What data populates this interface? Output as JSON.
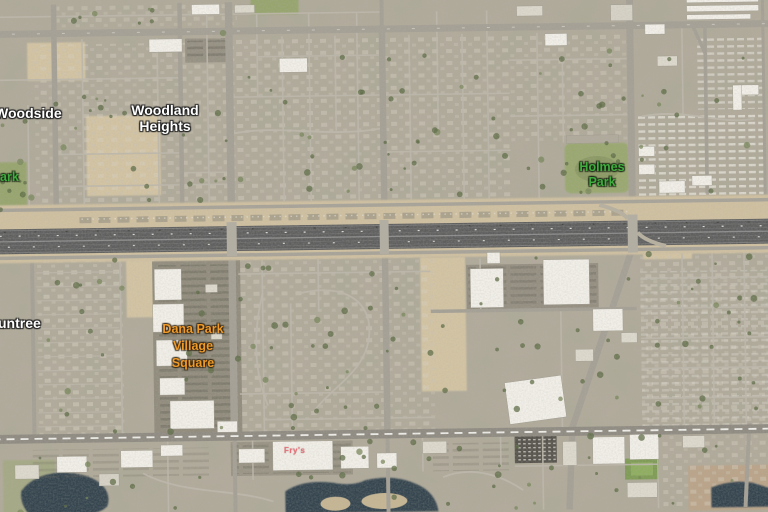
{
  "map": {
    "labels": {
      "woodside": {
        "text": "Woodside"
      },
      "woodland_heights": {
        "line1": "Woodland",
        "line2": "Heights"
      },
      "park_west_clipped": {
        "text": "ark"
      },
      "holmes_park": {
        "line1": "Holmes",
        "line2": "Park"
      },
      "suntree_clipped": {
        "text": "untree"
      },
      "dana_park": {
        "line1": "Dana Park",
        "line2": "Village",
        "line3": "Square"
      },
      "rooftop_sign": {
        "text": "Fry's"
      }
    }
  },
  "colors": {
    "label-white": "#ffffff",
    "label-green": "#3fae3f",
    "label-orange": "#f09a28",
    "label-sign": "#e8707a",
    "water": "#36454f",
    "park-green": "#97a56e",
    "desert-tan": "#d3c4a3",
    "freeway-gray": "#5e5e5e",
    "base-ground": "#b2ab9c"
  }
}
